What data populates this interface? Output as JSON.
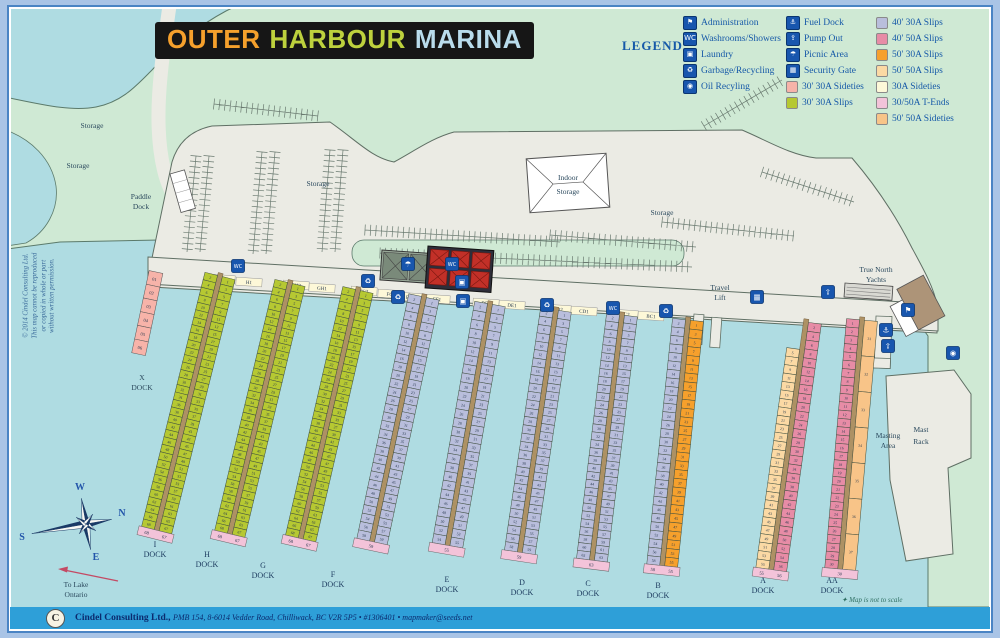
{
  "title": {
    "part1": "OUTER",
    "part2": "HARBOUR",
    "part3": "MARINA"
  },
  "legend": {
    "heading": "LEGEND",
    "facilities": [
      {
        "name": "administration-icon",
        "glyph": "⚑",
        "label": "Administration"
      },
      {
        "name": "washrooms-icon",
        "glyph": "WC",
        "label": "Washrooms/Showers"
      },
      {
        "name": "laundry-icon",
        "glyph": "▣",
        "label": "Laundry"
      },
      {
        "name": "garbage-recycling-icon",
        "glyph": "♻",
        "label": "Garbage/Recycling"
      },
      {
        "name": "oil-recycling-icon",
        "glyph": "◉",
        "label": "Oil Recyling"
      }
    ],
    "services": [
      {
        "name": "fuel-dock-icon",
        "glyph": "⚓",
        "label": "Fuel Dock"
      },
      {
        "name": "pump-out-icon",
        "glyph": "⇪",
        "label": "Pump Out"
      },
      {
        "name": "picnic-area-icon",
        "glyph": "☂",
        "label": "Picnic Area"
      },
      {
        "name": "security-gate-icon",
        "glyph": "▦",
        "label": "Security Gate"
      }
    ],
    "swatches_mid": [
      {
        "key": "sidetie30",
        "label": "30' 30A Sideties"
      },
      {
        "key": "slip30",
        "label": "30' 30A Slips"
      }
    ],
    "swatches_right": [
      {
        "key": "slip40_30",
        "label": "40' 30A Slips"
      },
      {
        "key": "slip40_50",
        "label": "40' 50A Slips"
      },
      {
        "key": "slip50_30",
        "label": "50' 30A Slips"
      },
      {
        "key": "slip50_50",
        "label": "50' 50A Slips"
      },
      {
        "key": "sidetieA",
        "label": "30A Sideties"
      },
      {
        "key": "tend",
        "label": "30/50A T-Ends"
      },
      {
        "key": "sidetie50_50",
        "label": "50' 50A Sideties"
      }
    ]
  },
  "colors": {
    "water": "#afdce2",
    "green": "#cfe9d4",
    "green_line": "#5b7a6b",
    "paved": "#ebebe4",
    "paved_line": "#5f6f64",
    "margin": "#a9c4e6",
    "frame": "#4a84c4",
    "footer": "#2e9fd8",
    "icon": "#1856ae",
    "icon_line": "#0a3570",
    "title_bg": "#161616",
    "t_orange": "#f5a02c",
    "t_green": "#bdd13d",
    "t_blue": "#b9dcec",
    "legend_text": "#1659a8",
    "spine": "#ad9164",
    "map_text": "#2c4a5e",
    "dock_text": "#1c3a5e",
    "slip30": "#b6c832",
    "sidetie30": "#f7b3a9",
    "slip40_30": "#b9bedc",
    "slip40_50": "#e78ca6",
    "slip50_30": "#f6a02c",
    "slip50_50": "#fbd9a4",
    "sidetieA": "#fdf8d8",
    "tend": "#f3c3d9",
    "sidetie50_50": "#f8c488",
    "num": "#26384e",
    "note": "#2e6e62",
    "arrow": "#c44a64",
    "compass": "#1a3a66"
  },
  "map": {
    "labels": [
      {
        "t": "Storage",
        "x": 92,
        "y": 128
      },
      {
        "t": "Storage",
        "x": 78,
        "y": 168
      },
      {
        "t": "Storage",
        "x": 318,
        "y": 186
      },
      {
        "t": "Storage",
        "x": 662,
        "y": 215
      },
      {
        "t": "Paddle",
        "x": 141,
        "y": 199
      },
      {
        "t": "Dock",
        "x": 141,
        "y": 209
      },
      {
        "t": "Travel",
        "x": 720,
        "y": 290
      },
      {
        "t": "Lift",
        "x": 720,
        "y": 300
      },
      {
        "t": "True North",
        "x": 876,
        "y": 272
      },
      {
        "t": "Yachts",
        "x": 876,
        "y": 282
      },
      {
        "t": "Indoor",
        "x": 568,
        "y": 180
      },
      {
        "t": "Storage",
        "x": 568,
        "y": 194
      },
      {
        "t": "Mast",
        "x": 921,
        "y": 432
      },
      {
        "t": "Rack",
        "x": 921,
        "y": 444
      },
      {
        "t": "Masting",
        "x": 888,
        "y": 438
      },
      {
        "t": "Area",
        "x": 888,
        "y": 448
      },
      {
        "t": "X",
        "x": 142,
        "y": 380
      },
      {
        "t": "DOCK",
        "x": 142,
        "y": 390
      },
      {
        "t": "To Lake",
        "x": 76,
        "y": 587
      },
      {
        "t": "Ontario",
        "x": 76,
        "y": 597
      }
    ],
    "icons": [
      {
        "name": "washrooms-icon",
        "glyph": "WC",
        "x": 238,
        "y": 266
      },
      {
        "name": "garbage-recycling-icon",
        "glyph": "♻",
        "x": 368,
        "y": 281
      },
      {
        "name": "picnic-area-icon",
        "glyph": "☂",
        "x": 408,
        "y": 264
      },
      {
        "name": "washrooms-icon",
        "glyph": "WC",
        "x": 452,
        "y": 264
      },
      {
        "name": "laundry-icon",
        "glyph": "▣",
        "x": 462,
        "y": 282
      },
      {
        "name": "garbage-recycling-icon",
        "glyph": "♻",
        "x": 398,
        "y": 297
      },
      {
        "name": "laundry-icon",
        "glyph": "▣",
        "x": 463,
        "y": 301
      },
      {
        "name": "garbage-recycling-icon",
        "glyph": "♻",
        "x": 547,
        "y": 305
      },
      {
        "name": "washrooms-icon",
        "glyph": "WC",
        "x": 613,
        "y": 308
      },
      {
        "name": "garbage-recycling-icon",
        "glyph": "♻",
        "x": 666,
        "y": 311
      },
      {
        "name": "security-gate-icon",
        "glyph": "▦",
        "x": 757,
        "y": 297
      },
      {
        "name": "pump-out-icon",
        "glyph": "⇪",
        "x": 828,
        "y": 292
      },
      {
        "name": "administration-icon",
        "glyph": "⚑",
        "x": 908,
        "y": 310
      },
      {
        "name": "fuel-dock-icon",
        "glyph": "⚓",
        "x": 886,
        "y": 330
      },
      {
        "name": "pump-out-icon",
        "glyph": "⇪",
        "x": 888,
        "y": 346
      },
      {
        "name": "oil-recycling-icon",
        "glyph": "◉",
        "x": 953,
        "y": 353
      }
    ],
    "sideties": [
      {
        "t": "H2",
        "x": 222,
        "y": 279
      },
      {
        "t": "H1",
        "x": 249,
        "y": 282
      },
      {
        "t": "GH2",
        "x": 296,
        "y": 285
      },
      {
        "t": "GH1",
        "x": 322,
        "y": 288
      },
      {
        "t": "FG2",
        "x": 364,
        "y": 291
      },
      {
        "t": "FG1",
        "x": 391,
        "y": 294
      },
      {
        "t": "EF2",
        "x": 410,
        "y": 297
      },
      {
        "t": "EF1",
        "x": 437,
        "y": 299
      },
      {
        "t": "DE2",
        "x": 486,
        "y": 303
      },
      {
        "t": "DE1",
        "x": 512,
        "y": 305
      },
      {
        "t": "CD2",
        "x": 558,
        "y": 309
      },
      {
        "t": "CD1",
        "x": 584,
        "y": 311
      },
      {
        "t": "BC2",
        "x": 625,
        "y": 314
      },
      {
        "t": "BC1",
        "x": 651,
        "y": 316
      }
    ],
    "xdock": {
      "x": 156,
      "y": 272,
      "angle": 12,
      "cells": [
        "01",
        "02",
        "03",
        "04",
        "05",
        "06"
      ]
    },
    "docks": [
      {
        "id": "I",
        "x": 220,
        "y": 276,
        "angle": 14,
        "len": 262,
        "left": {
          "key": "slip30",
          "start": 2,
          "step": 2,
          "count": 34
        },
        "right": {
          "key": "slip30",
          "start": 1,
          "step": 2,
          "count": 34
        },
        "tend": [
          "68",
          "67"
        ],
        "label": [
          "I",
          "DOCK"
        ],
        "lx": 155,
        "ly": 547
      },
      {
        "id": "H",
        "x": 290,
        "y": 283,
        "angle": 13.5,
        "len": 258,
        "left": {
          "key": "slip30",
          "start": 2,
          "step": 2,
          "count": 34
        },
        "right": {
          "key": "slip30",
          "start": 1,
          "step": 2,
          "count": 34
        },
        "tend": [
          "68",
          "67"
        ],
        "label": [
          "H",
          "DOCK"
        ],
        "lx": 207,
        "ly": 557
      },
      {
        "id": "G",
        "x": 358,
        "y": 290,
        "angle": 13,
        "len": 255,
        "left": {
          "key": "slip30",
          "start": 2,
          "step": 2,
          "count": 34
        },
        "right": {
          "key": "slip30",
          "start": 1,
          "step": 2,
          "count": 34
        },
        "tend": [
          "68",
          "67"
        ],
        "label": [
          "G",
          "DOCK"
        ],
        "lx": 263,
        "ly": 568
      },
      {
        "id": "F",
        "x": 424,
        "y": 297,
        "angle": 12,
        "len": 250,
        "left": {
          "key": "slip40_30",
          "start": 2,
          "step": 2,
          "count": 29
        },
        "right": {
          "key": "slip40_30",
          "start": 1,
          "step": 2,
          "count": 30
        },
        "tend": [
          "59"
        ],
        "label": [
          "F",
          "DOCK"
        ],
        "lx": 333,
        "ly": 577
      },
      {
        "id": "E",
        "x": 490,
        "y": 304,
        "angle": 10,
        "len": 245,
        "left": {
          "key": "slip40_30",
          "start": 2,
          "step": 2,
          "count": 27
        },
        "right": {
          "key": "slip40_30",
          "start": 1,
          "step": 2,
          "count": 28
        },
        "tend": [
          "55"
        ],
        "label": [
          "E",
          "DOCK"
        ],
        "lx": 447,
        "ly": 582
      },
      {
        "id": "D",
        "x": 556,
        "y": 310,
        "angle": 8.5,
        "len": 245,
        "left": {
          "key": "slip40_30",
          "start": 2,
          "step": 2,
          "count": 29
        },
        "right": {
          "key": "slip40_30",
          "start": 1,
          "step": 2,
          "count": 30
        },
        "tend": [
          "59"
        ],
        "label": [
          "D",
          "DOCK"
        ],
        "lx": 522,
        "ly": 585
      },
      {
        "id": "C",
        "x": 622,
        "y": 315,
        "angle": 7,
        "len": 247,
        "left": {
          "key": "slip40_30",
          "start": 2,
          "step": 2,
          "count": 31
        },
        "right": {
          "key": "slip40_30",
          "start": 1,
          "step": 2,
          "count": 32
        },
        "tend": [
          "63"
        ],
        "label": [
          "C",
          "DOCK"
        ],
        "lx": 588,
        "ly": 586
      },
      {
        "id": "B",
        "x": 688,
        "y": 320,
        "angle": 6,
        "len": 247,
        "left": {
          "key": "slip40_30",
          "start": 2,
          "step": 2,
          "count": 29
        },
        "right": {
          "key": "slip50_30",
          "start": 1,
          "step": 2,
          "count": 28
        },
        "tend": [
          "58",
          "55"
        ],
        "label": [
          "B",
          "DOCK"
        ],
        "lx": 658,
        "ly": 588
      },
      {
        "id": "A",
        "x": 806,
        "y": 322,
        "angle": 8,
        "len": 250,
        "left": {
          "key": "slip50_50",
          "start": 5,
          "step": 2,
          "count": 26,
          "y0": 28
        },
        "right": {
          "key": "slip40_50",
          "start": 2,
          "step": 2,
          "count": 28
        },
        "tend": [
          "55",
          "56"
        ],
        "label": [
          "A",
          "DOCK"
        ],
        "lx": 763,
        "ly": 583
      },
      {
        "id": "AA",
        "x": 862,
        "y": 320,
        "angle": 5,
        "len": 250,
        "left": {
          "key": "slip40_50",
          "start": 1,
          "step": 1,
          "count": 30
        },
        "right": {
          "key": "sidetie50_50",
          "start": 31,
          "step": 1,
          "count": 7
        },
        "tend": [
          "30"
        ],
        "label": [
          "AA",
          "DOCK"
        ],
        "lx": 832,
        "ly": 583
      }
    ],
    "combs": [
      [
        196,
        156,
        187,
        252
      ],
      [
        209,
        156,
        200,
        252
      ],
      [
        262,
        152,
        253,
        254
      ],
      [
        275,
        152,
        266,
        254
      ],
      [
        330,
        150,
        322,
        252
      ],
      [
        343,
        150,
        335,
        252
      ],
      [
        365,
        230,
        560,
        242
      ],
      [
        380,
        253,
        692,
        267
      ],
      [
        550,
        235,
        696,
        247
      ],
      [
        662,
        222,
        794,
        236
      ],
      [
        704,
        126,
        782,
        80
      ],
      [
        762,
        172,
        854,
        202
      ],
      [
        520,
        292,
        688,
        303
      ],
      [
        214,
        104,
        318,
        116
      ]
    ],
    "compass": {
      "n": "N",
      "e": "E",
      "s": "S",
      "w": "W"
    },
    "note": "✦ Map is not to scale",
    "copyright": [
      "© 2014 Cindel Consulting Ltd.",
      "This map cannot be reproduced",
      "or copied in whole or part",
      "without written permission."
    ]
  },
  "footer": {
    "company": "Cindel Consulting Ltd.,",
    "details": "PMB 154, 8-6014 Vedder Road, Chilliwack, BC V2R 5P5 • #1306401 • mapmaker@seeds.net",
    "logo": "C"
  }
}
